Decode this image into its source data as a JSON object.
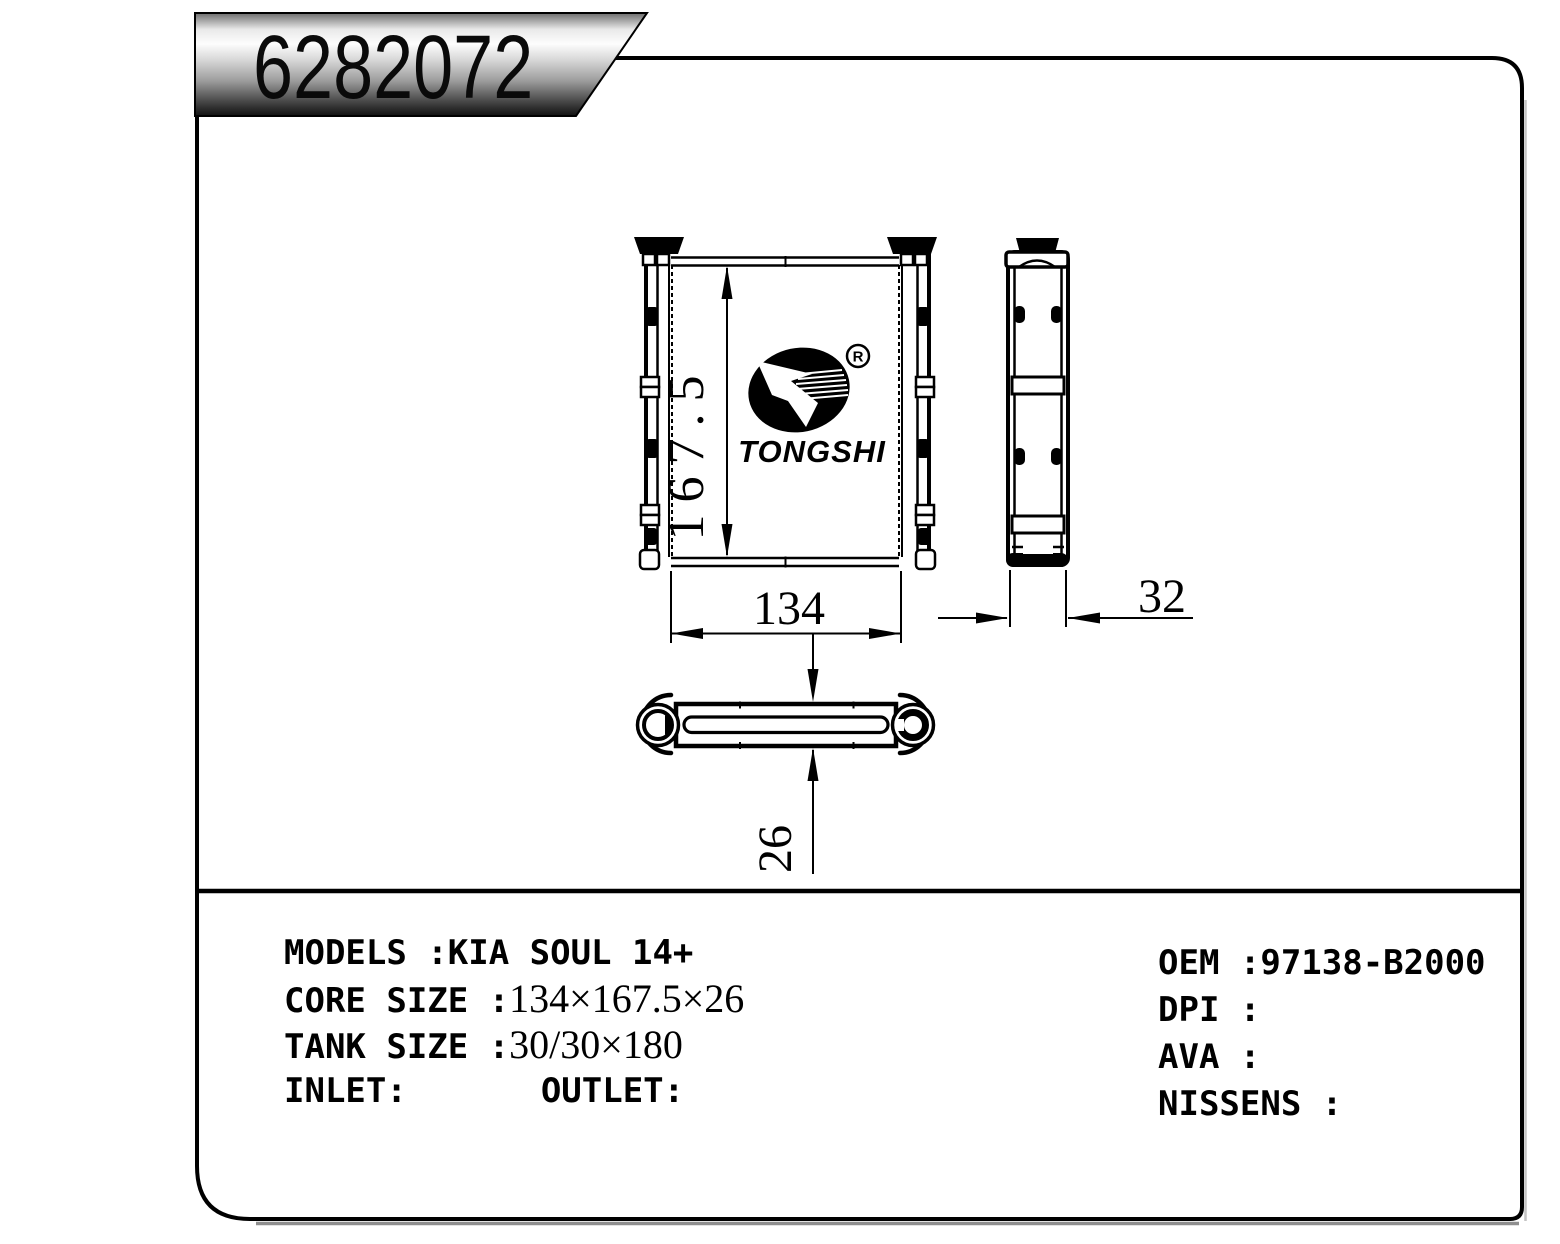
{
  "banner": {
    "part_number": "6282072"
  },
  "logo": {
    "name": "TONGSHI",
    "registered_mark": "R"
  },
  "drawing": {
    "front_view": {
      "height_label": "167.5",
      "width_label": "134"
    },
    "side_view": {
      "depth_label": "32"
    },
    "top_view": {
      "thickness_label": "26"
    }
  },
  "specs": {
    "left": [
      {
        "label": "MODELS :",
        "value": "KIA SOUL 14+"
      },
      {
        "label": "CORE SIZE :",
        "value": "134×167.5×26"
      },
      {
        "label": "TANK SIZE :",
        "value": "30/30×180"
      },
      {
        "label": "INLET:",
        "label2": "OUTLET:"
      }
    ],
    "right": [
      {
        "label": "OEM :",
        "value": "97138-B2000"
      },
      {
        "label": "DPI :",
        "value": ""
      },
      {
        "label": "AVA :",
        "value": ""
      },
      {
        "label": "NISSENS :",
        "value": ""
      }
    ]
  },
  "colors": {
    "line": "#000000",
    "background": "#ffffff",
    "shadow": "#8f8f8f"
  }
}
